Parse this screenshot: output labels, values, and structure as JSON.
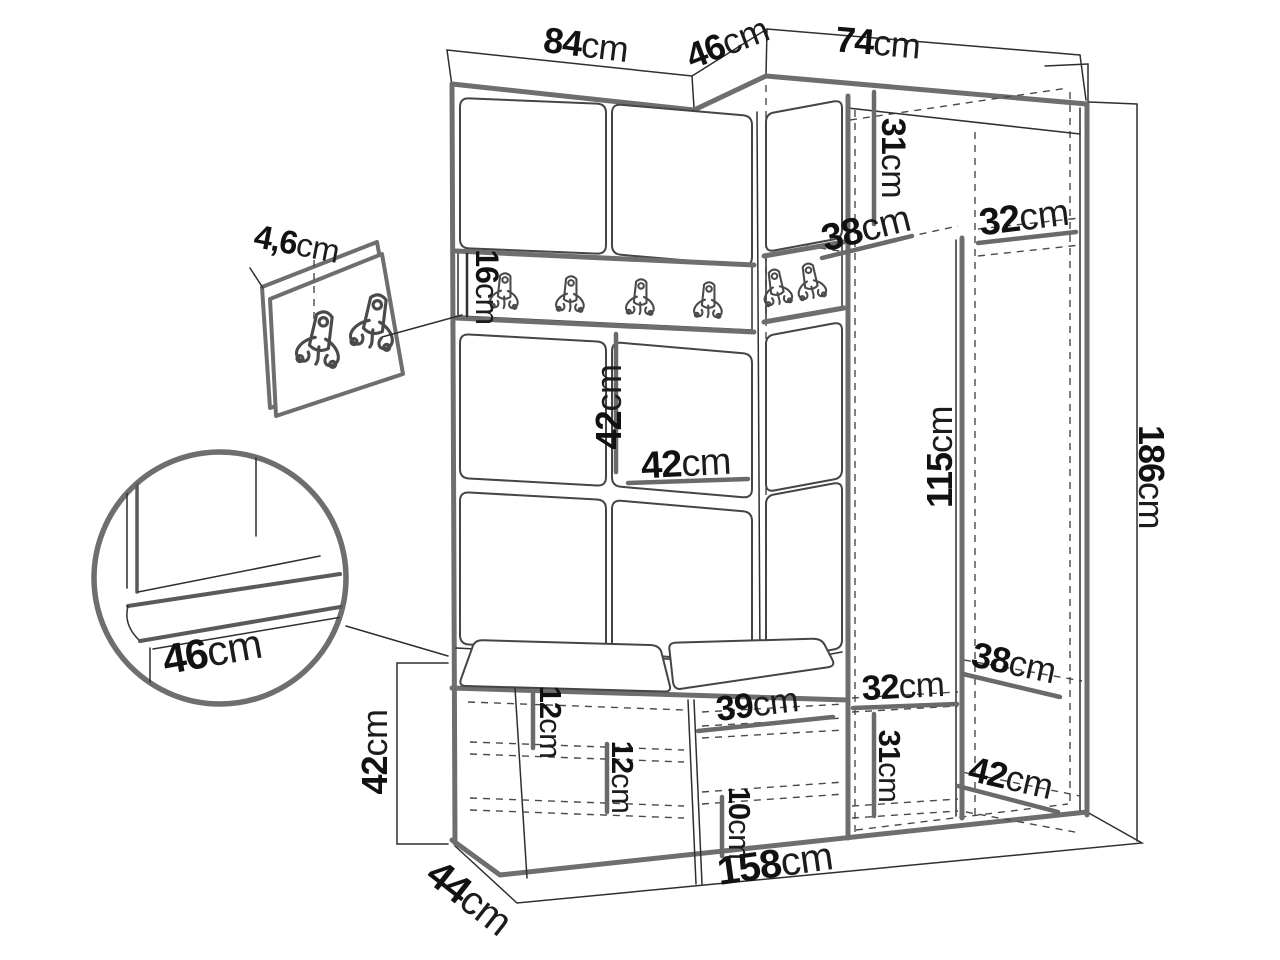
{
  "colors": {
    "background": "#ffffff",
    "outline_thick": "#6e6e6e",
    "outline_thin": "#2f2f2f",
    "dashed_line": "#4a4a4a",
    "text": "#111111"
  },
  "labels": {
    "top_width_left": {
      "value": "84",
      "unit": "cm"
    },
    "top_depth_corner": {
      "value": "46",
      "unit": "cm"
    },
    "top_width_right": {
      "value": "74",
      "unit": "cm"
    },
    "hook_panel_thickness": {
      "value": "4,6",
      "unit": "cm"
    },
    "coat_rail_height": {
      "value": "16",
      "unit": "cm"
    },
    "upper_compartment_height": {
      "value": "31",
      "unit": "cm"
    },
    "upper_corner_shelf_depth": {
      "value": "38",
      "unit": "cm"
    },
    "upper_right_shelf_width": {
      "value": "32",
      "unit": "cm"
    },
    "mid_panel_width": {
      "value": "42",
      "unit": "cm"
    },
    "mid_panel_height": {
      "value": "42",
      "unit": "cm"
    },
    "tall_compartment_height": {
      "value": "115",
      "unit": "cm"
    },
    "total_height": {
      "value": "186",
      "unit": "cm"
    },
    "seat_detail_depth": {
      "value": "46",
      "unit": "cm"
    },
    "bench_height": {
      "value": "42",
      "unit": "cm"
    },
    "bench_shelf_spacing_left": {
      "value": "12",
      "unit": "cm"
    },
    "bench_shelf_spacing_right": {
      "value": "12",
      "unit": "cm"
    },
    "bench_compartment_width": {
      "value": "39",
      "unit": "cm"
    },
    "bench_bottom_spacing": {
      "value": "10",
      "unit": "cm"
    },
    "lower_shelf_width": {
      "value": "32",
      "unit": "cm"
    },
    "lower_compartment_height": {
      "value": "31",
      "unit": "cm"
    },
    "lower_shelf_depth_upper": {
      "value": "38",
      "unit": "cm"
    },
    "lower_shelf_depth_lower": {
      "value": "42",
      "unit": "cm"
    },
    "total_width": {
      "value": "158",
      "unit": "cm"
    },
    "bench_depth": {
      "value": "44",
      "unit": "cm"
    }
  }
}
